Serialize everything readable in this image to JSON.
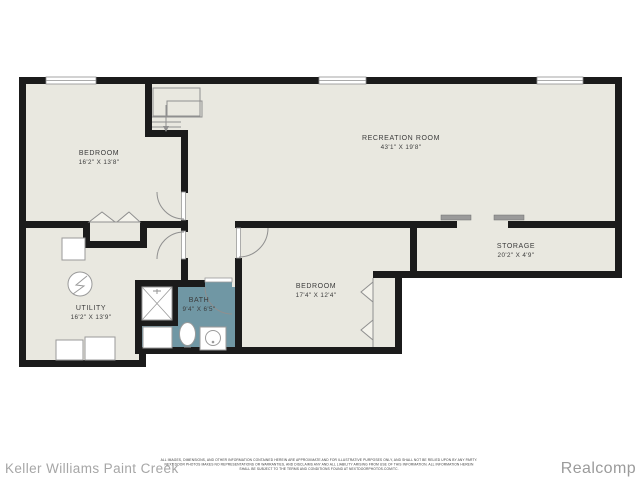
{
  "colors": {
    "floor": "#e9e8e0",
    "bath_floor": "#7097a4",
    "wall": "#1b1b1b",
    "line_gray": "#8f8f8f",
    "label_text": "#3b3b3b",
    "footer_text": "#a6a6a6"
  },
  "rooms": [
    {
      "id": "bedroom-1",
      "name": "BEDROOM",
      "dims": "16'2\" X 13'8\""
    },
    {
      "id": "recreation-room",
      "name": "RECREATION ROOM",
      "dims": "43'1\" X 19'8\""
    },
    {
      "id": "storage",
      "name": "STORAGE",
      "dims": "20'2\" X 4'9\""
    },
    {
      "id": "bedroom-2",
      "name": "BEDROOM",
      "dims": "17'4\" X 12'4\""
    },
    {
      "id": "bath",
      "name": "BATH",
      "dims": "9'4\" X 6'5\""
    },
    {
      "id": "utility",
      "name": "UTILITY",
      "dims": "16'2\" X 13'9\""
    }
  ],
  "icons": {
    "stairs-icon": "svg-shape",
    "window-icon": "svg-shape",
    "door-arc-icon": "svg-shape",
    "bifold-door-icon": "svg-shape",
    "sliding-door-icon": "svg-shape",
    "shower-icon": "svg-shape",
    "toilet-icon": "svg-shape",
    "sink-icon": "svg-shape",
    "electrical-panel-icon": "svg-shape",
    "furnace-icon": "svg-shape",
    "washer-icon": "svg-shape",
    "dryer-icon": "svg-shape"
  },
  "footer": {
    "agency": "Keller Williams Paint Creek",
    "provider": "Realcomp",
    "disclaimer": [
      "ALL IMAGES, DIMENSIONS, AND OTHER INFORMATION CONTAINED HEREIN ARE APPROXIMATE AND FOR ILLUSTRATIVE PURPOSES ONLY, AND SHALL NOT BE RELIED UPON BY ANY PARTY.",
      "NEXT DOOR PHOTOS MAKES NO REPRESENTATIONS OR WARRANTIES, AND DISCLAIMS ANY AND ALL LIABILITY ARISING FROM USE OF THIS INFORMATION. ALL INFORMATION HEREIN",
      "SHALL BE SUBJECT TO THE TERMS AND CONDITIONS FOUND AT NEXTDOORPHOTOS.COM/TC."
    ]
  }
}
